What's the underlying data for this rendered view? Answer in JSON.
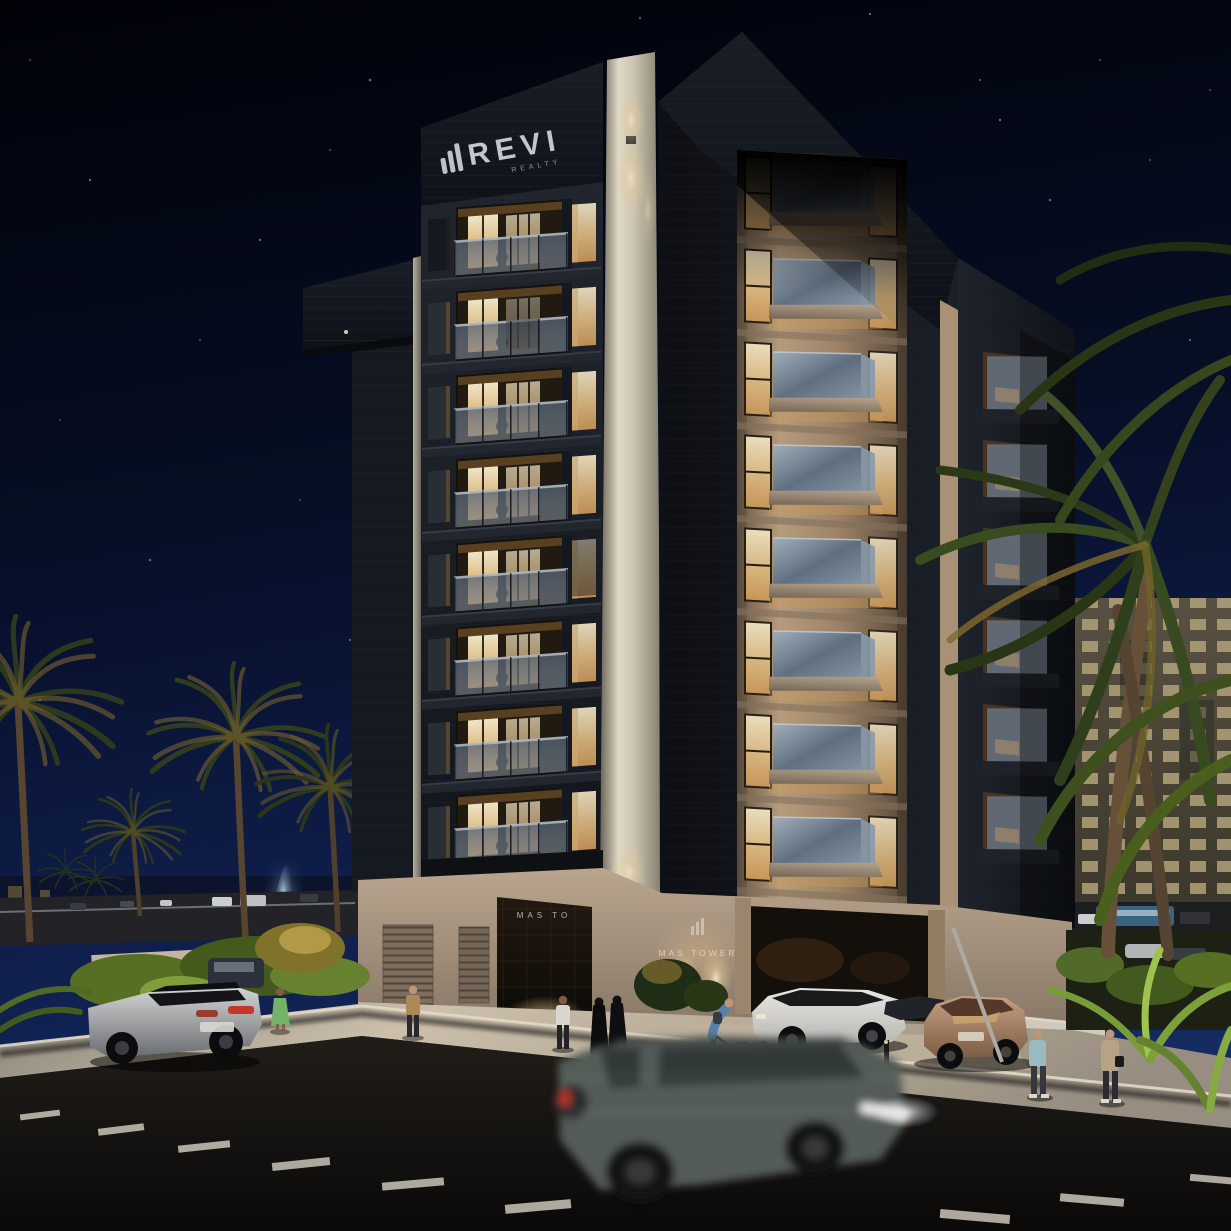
{
  "scene": {
    "title": "MAS Tower — night architectural rendering",
    "branding": {
      "logo_text": "REVI",
      "logo_subtext": "REALTY",
      "logo_icon": "bar-chart-icon"
    },
    "signage": {
      "portal_text": "MAS TO",
      "wall_sign_text": "MAS TOWER",
      "wall_sign_icon": "bar-chart-icon"
    },
    "palette": {
      "sky_top": "#020309",
      "sky_bottom": "#18306b",
      "facade_dark": "#1a1e26",
      "facade_beige": "#b59a7d",
      "window_warm": "#f3d9a4",
      "cream_column": "#efe7d4",
      "podium": "#b4a08c",
      "sidewalk": "#d9ccb7",
      "road": "#14110e",
      "palm_green": "#3f5222",
      "palm_gold": "#8a7433",
      "taillight_red": "#d23b2f",
      "headlight_white": "#ffffff"
    }
  }
}
